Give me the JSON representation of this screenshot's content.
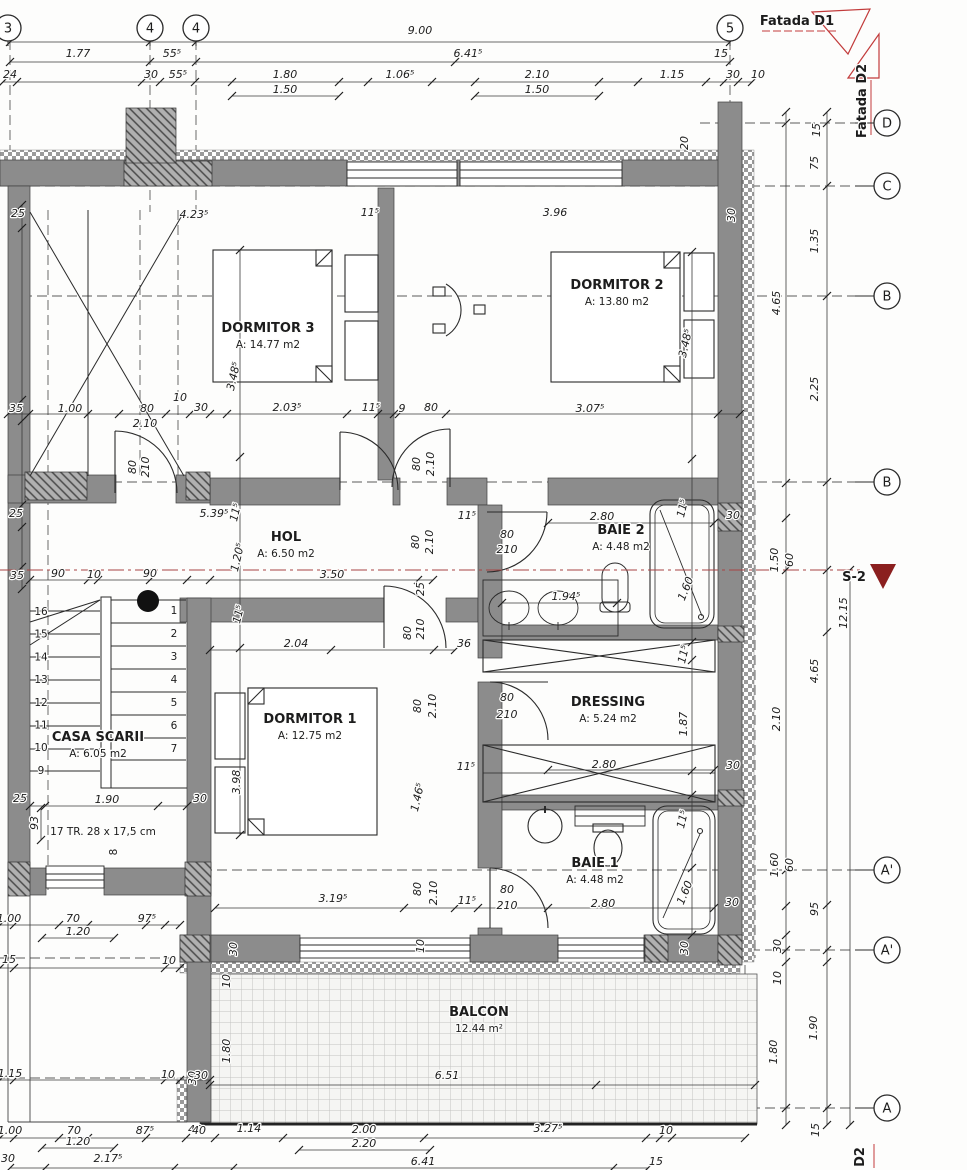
{
  "colors": {
    "wall": "#8c8c8c",
    "line": "#2a2a2a",
    "red": "#c23b3b",
    "dark_red": "#8b1f1f",
    "dim_text": "#1c1c1c"
  },
  "grid": {
    "top": [
      {
        "label": "3",
        "x": 8
      },
      {
        "label": "4",
        "x": 150
      },
      {
        "label": "4",
        "x": 196
      },
      {
        "label": "5",
        "x": 730
      }
    ],
    "right": [
      {
        "label": "D",
        "y": 123
      },
      {
        "label": "C",
        "y": 186
      },
      {
        "label": "B",
        "y": 296
      },
      {
        "label": "B",
        "y": 482
      },
      {
        "label": "A'",
        "y": 870
      },
      {
        "label": "A'",
        "y": 950
      },
      {
        "label": "A",
        "y": 1108
      }
    ]
  },
  "rooms": [
    {
      "name": "DORMITOR 3",
      "area": "A: 14.77 m2",
      "x": 268,
      "y": 332
    },
    {
      "name": "DORMITOR 2",
      "area": "A: 13.80 m2",
      "x": 617,
      "y": 289
    },
    {
      "name": "DORMITOR 1",
      "area": "A: 12.75 m2",
      "x": 310,
      "y": 723
    },
    {
      "name": "HOL",
      "area": "A: 6.50 m2",
      "x": 286,
      "y": 541
    },
    {
      "name": "BAIE 2",
      "area": "A: 4.48 m2",
      "x": 621,
      "y": 534
    },
    {
      "name": "DRESSING",
      "area": "A: 5.24 m2",
      "x": 608,
      "y": 706
    },
    {
      "name": "BAIE 1",
      "area": "A: 4.48 m2",
      "x": 595,
      "y": 867
    },
    {
      "name": "BALCON",
      "area": "12.44 m²",
      "x": 479,
      "y": 1016
    }
  ],
  "stairs": {
    "label": "CASA SCARII",
    "area": "A: 6.05 m2",
    "note": "17 TR. 28 x 17,5 cm",
    "extra_step": "8",
    "left_numbers": [
      "16",
      "15",
      "14",
      "13",
      "12",
      "11",
      "10",
      "9"
    ],
    "right_numbers": [
      "1",
      "2",
      "3",
      "4",
      "5",
      "6",
      "7"
    ]
  },
  "annotations": {
    "fatada_d1": {
      "t": "Fatada D1",
      "x": 797,
      "y": 25
    },
    "fatada_d2": {
      "t": "Fatada D2",
      "x": 866,
      "y": 101,
      "r": -90
    },
    "section": {
      "t": "S-2",
      "x": 854,
      "y": 581
    },
    "section_bottom": {
      "t": "D2",
      "x": 864,
      "y": 1157,
      "r": -90
    }
  },
  "dim_labels": [
    {
      "t": "9.00",
      "x": 420,
      "y": 34
    },
    {
      "t": "1.77",
      "x": 78,
      "y": 57
    },
    {
      "t": "55⁵",
      "x": 172,
      "y": 57
    },
    {
      "t": "6.41⁵",
      "x": 468,
      "y": 57
    },
    {
      "t": "15",
      "x": 721,
      "y": 57
    },
    {
      "t": "24",
      "x": 10,
      "y": 78
    },
    {
      "t": "30",
      "x": 151,
      "y": 78
    },
    {
      "t": "55⁵",
      "x": 178,
      "y": 78
    },
    {
      "t": "1.80",
      "x": 285,
      "y": 78
    },
    {
      "t": "1.06⁵",
      "x": 400,
      "y": 78
    },
    {
      "t": "2.10",
      "x": 537,
      "y": 78
    },
    {
      "t": "1.15",
      "x": 672,
      "y": 78
    },
    {
      "t": "30",
      "x": 733,
      "y": 78
    },
    {
      "t": "10",
      "x": 758,
      "y": 78
    },
    {
      "t": "1.50",
      "x": 285,
      "y": 93
    },
    {
      "t": "1.50",
      "x": 537,
      "y": 93
    },
    {
      "t": "20",
      "x": 688,
      "y": 143,
      "r": -90
    },
    {
      "t": "15",
      "x": 820,
      "y": 130,
      "r": -90
    },
    {
      "t": "75",
      "x": 818,
      "y": 163,
      "r": -90
    },
    {
      "t": "1.35",
      "x": 818,
      "y": 241,
      "r": -90
    },
    {
      "t": "2.25",
      "x": 818,
      "y": 389,
      "r": -90
    },
    {
      "t": "4.65",
      "x": 780,
      "y": 303,
      "r": -90
    },
    {
      "t": "1.50",
      "x": 778,
      "y": 560,
      "r": -90
    },
    {
      "t": "60",
      "x": 793,
      "y": 560,
      "r": -90
    },
    {
      "t": "12.15",
      "x": 847,
      "y": 613,
      "r": -90
    },
    {
      "t": "4.65",
      "x": 818,
      "y": 671,
      "r": -90
    },
    {
      "t": "2.10",
      "x": 780,
      "y": 719,
      "r": -90
    },
    {
      "t": "1.60",
      "x": 778,
      "y": 865,
      "r": -90
    },
    {
      "t": "60",
      "x": 793,
      "y": 865,
      "r": -90
    },
    {
      "t": "95",
      "x": 818,
      "y": 909,
      "r": -90
    },
    {
      "t": "30",
      "x": 781,
      "y": 946,
      "r": -90
    },
    {
      "t": "10",
      "x": 781,
      "y": 978,
      "r": -90
    },
    {
      "t": "1.90",
      "x": 817,
      "y": 1028,
      "r": -90
    },
    {
      "t": "1.80",
      "x": 777,
      "y": 1052,
      "r": -90
    },
    {
      "t": "15",
      "x": 819,
      "y": 1130,
      "r": -90
    },
    {
      "t": "25",
      "x": 18,
      "y": 217
    },
    {
      "t": "4.23⁵",
      "x": 194,
      "y": 218
    },
    {
      "t": "11⁵",
      "x": 370,
      "y": 216
    },
    {
      "t": "3.96",
      "x": 555,
      "y": 216
    },
    {
      "t": "30",
      "x": 735,
      "y": 215,
      "r": -90
    },
    {
      "t": "3.48⁵",
      "x": 237,
      "y": 377,
      "r": -77
    },
    {
      "t": "3.48⁵",
      "x": 689,
      "y": 344,
      "r": -77
    },
    {
      "t": "35",
      "x": 16,
      "y": 412
    },
    {
      "t": "1.00",
      "x": 70,
      "y": 412
    },
    {
      "t": "80",
      "x": 147,
      "y": 412
    },
    {
      "t": "2.10",
      "x": 145,
      "y": 427
    },
    {
      "t": "10",
      "x": 180,
      "y": 401
    },
    {
      "t": "30",
      "x": 201,
      "y": 411
    },
    {
      "t": "2.03⁵",
      "x": 287,
      "y": 411
    },
    {
      "t": "11⁵",
      "x": 371,
      "y": 411
    },
    {
      "t": "9",
      "x": 402,
      "y": 412
    },
    {
      "t": "80",
      "x": 431,
      "y": 411
    },
    {
      "t": "3.07⁵",
      "x": 590,
      "y": 412
    },
    {
      "t": "80",
      "x": 420,
      "y": 464,
      "r": -90
    },
    {
      "t": "2.10",
      "x": 434,
      "y": 464,
      "r": -90
    },
    {
      "t": "80",
      "x": 136,
      "y": 467,
      "r": -90
    },
    {
      "t": "210",
      "x": 149,
      "y": 467,
      "r": -90
    },
    {
      "t": "25",
      "x": 16,
      "y": 517
    },
    {
      "t": "5.39⁵",
      "x": 214,
      "y": 517
    },
    {
      "t": "11⁵",
      "x": 239,
      "y": 513,
      "r": -77
    },
    {
      "t": "1.20⁵",
      "x": 241,
      "y": 558,
      "r": -77
    },
    {
      "t": "3.50",
      "x": 332,
      "y": 578
    },
    {
      "t": "80",
      "x": 419,
      "y": 542,
      "r": -90
    },
    {
      "t": "2.10",
      "x": 433,
      "y": 542,
      "r": -90
    },
    {
      "t": "25",
      "x": 424,
      "y": 589,
      "r": -90
    },
    {
      "t": "11⁵",
      "x": 467,
      "y": 519
    },
    {
      "t": "80",
      "x": 507,
      "y": 538
    },
    {
      "t": "210",
      "x": 507,
      "y": 553
    },
    {
      "t": "2.80",
      "x": 602,
      "y": 520
    },
    {
      "t": "11⁵",
      "x": 686,
      "y": 509,
      "r": -77
    },
    {
      "t": "30",
      "x": 733,
      "y": 519
    },
    {
      "t": "1.94⁵",
      "x": 566,
      "y": 600
    },
    {
      "t": "1.60",
      "x": 689,
      "y": 590,
      "r": -68
    },
    {
      "t": "35",
      "x": 17,
      "y": 579
    },
    {
      "t": "90",
      "x": 58,
      "y": 577
    },
    {
      "t": "10",
      "x": 94,
      "y": 578
    },
    {
      "t": "90",
      "x": 150,
      "y": 577
    },
    {
      "t": "11⁵",
      "x": 242,
      "y": 615,
      "r": -77
    },
    {
      "t": "25",
      "x": 20,
      "y": 802
    },
    {
      "t": "1.90",
      "x": 107,
      "y": 803
    },
    {
      "t": "30",
      "x": 200,
      "y": 802
    },
    {
      "t": "93",
      "x": 38,
      "y": 823,
      "r": -90
    },
    {
      "t": "3.98",
      "x": 240,
      "y": 782,
      "r": -90
    },
    {
      "t": "2.04",
      "x": 296,
      "y": 647
    },
    {
      "t": "36",
      "x": 464,
      "y": 647
    },
    {
      "t": "80",
      "x": 411,
      "y": 633,
      "r": -90
    },
    {
      "t": "210",
      "x": 424,
      "y": 629,
      "r": -90
    },
    {
      "t": "80",
      "x": 421,
      "y": 706,
      "r": -90
    },
    {
      "t": "2.10",
      "x": 436,
      "y": 706,
      "r": -90
    },
    {
      "t": "1.46⁵",
      "x": 421,
      "y": 798,
      "r": -77
    },
    {
      "t": "11⁵",
      "x": 466,
      "y": 770
    },
    {
      "t": "3.19⁵",
      "x": 333,
      "y": 902
    },
    {
      "t": "80",
      "x": 421,
      "y": 889,
      "r": -90
    },
    {
      "t": "2.10",
      "x": 437,
      "y": 893,
      "r": -90
    },
    {
      "t": "11⁵",
      "x": 467,
      "y": 904
    },
    {
      "t": "30",
      "x": 237,
      "y": 949,
      "r": -90
    },
    {
      "t": "10",
      "x": 424,
      "y": 946,
      "r": -90
    },
    {
      "t": "80",
      "x": 507,
      "y": 701
    },
    {
      "t": "210",
      "x": 507,
      "y": 718
    },
    {
      "t": "11⁵",
      "x": 687,
      "y": 655,
      "r": -77
    },
    {
      "t": "1.87",
      "x": 687,
      "y": 724,
      "r": -90
    },
    {
      "t": "2.80",
      "x": 604,
      "y": 768
    },
    {
      "t": "30",
      "x": 733,
      "y": 769
    },
    {
      "t": "80",
      "x": 507,
      "y": 893
    },
    {
      "t": "210",
      "x": 507,
      "y": 909
    },
    {
      "t": "2.80",
      "x": 603,
      "y": 907
    },
    {
      "t": "11⁵",
      "x": 686,
      "y": 820,
      "r": -77
    },
    {
      "t": "1.60",
      "x": 688,
      "y": 894,
      "r": -68
    },
    {
      "t": "30",
      "x": 732,
      "y": 906
    },
    {
      "t": "30",
      "x": 688,
      "y": 948,
      "r": -90
    },
    {
      "t": "10",
      "x": 230,
      "y": 981,
      "r": -90
    },
    {
      "t": "1.80",
      "x": 230,
      "y": 1051,
      "r": -90
    },
    {
      "t": "30",
      "x": 196,
      "y": 1078,
      "r": -90
    },
    {
      "t": "6.51",
      "x": 447,
      "y": 1079
    },
    {
      "t": "40",
      "x": 195,
      "y": 1133
    },
    {
      "t": "1.14",
      "x": 249,
      "y": 1132
    },
    {
      "t": "2.00",
      "x": 364,
      "y": 1133
    },
    {
      "t": "2.20",
      "x": 364,
      "y": 1147
    },
    {
      "t": "3.27⁵",
      "x": 548,
      "y": 1132
    },
    {
      "t": "10",
      "x": 666,
      "y": 1134
    },
    {
      "t": "6.41",
      "x": 423,
      "y": 1165
    },
    {
      "t": "15",
      "x": 656,
      "y": 1165
    },
    {
      "t": "1.00",
      "x": 9,
      "y": 922
    },
    {
      "t": "70",
      "x": 73,
      "y": 922
    },
    {
      "t": "97⁵",
      "x": 147,
      "y": 922
    },
    {
      "t": "1.20",
      "x": 78,
      "y": 935
    },
    {
      "t": "15",
      "x": 9,
      "y": 963
    },
    {
      "t": "10",
      "x": 169,
      "y": 964
    },
    {
      "t": "1.15",
      "x": 10,
      "y": 1077
    },
    {
      "t": "10",
      "x": 168,
      "y": 1078
    },
    {
      "t": "30",
      "x": 201,
      "y": 1079
    },
    {
      "t": "1.00",
      "x": 10,
      "y": 1134
    },
    {
      "t": "70",
      "x": 74,
      "y": 1134
    },
    {
      "t": "87⁵",
      "x": 145,
      "y": 1134
    },
    {
      "t": "40",
      "x": 199,
      "y": 1134
    },
    {
      "t": "1.20",
      "x": 78,
      "y": 1145
    },
    {
      "t": "30",
      "x": 8,
      "y": 1162
    },
    {
      "t": "2.17⁵",
      "x": 108,
      "y": 1162
    }
  ],
  "ticks": [
    {
      "o": "h",
      "p": 42,
      "t": [
        10,
        150,
        196,
        730
      ]
    },
    {
      "o": "h",
      "p": 62,
      "t": [
        10,
        150,
        196,
        455,
        730
      ]
    },
    {
      "o": "h",
      "p": 82,
      "t": [
        3,
        17,
        142,
        160,
        195,
        232,
        339,
        368,
        432,
        475,
        599,
        638,
        706,
        724,
        738,
        752
      ]
    },
    {
      "o": "h",
      "p": 96,
      "t": [
        232,
        339
      ]
    },
    {
      "o": "h",
      "p": 96,
      "t": [
        475,
        599
      ]
    },
    {
      "o": "h",
      "p": 414,
      "t": [
        8,
        29,
        88,
        119,
        166,
        190,
        210,
        227,
        347,
        378,
        394,
        399,
        446,
        718,
        740
      ]
    },
    {
      "o": "h",
      "p": 580,
      "t": [
        30,
        88,
        98,
        150,
        187,
        210,
        418,
        433
      ]
    },
    {
      "o": "h",
      "p": 523,
      "t": [
        548,
        714
      ]
    },
    {
      "o": "h",
      "p": 603,
      "t": [
        502,
        617
      ]
    },
    {
      "o": "h",
      "p": 650,
      "t": [
        210,
        331,
        434,
        455
      ]
    },
    {
      "o": "h",
      "p": 770,
      "t": [
        548,
        714
      ]
    },
    {
      "o": "h",
      "p": 806,
      "t": [
        30,
        45,
        158,
        187
      ]
    },
    {
      "o": "h",
      "p": 908,
      "t": [
        215,
        404,
        455,
        478,
        548,
        714
      ]
    },
    {
      "o": "h",
      "p": 1085,
      "t": [
        210,
        596,
        755
      ]
    },
    {
      "o": "h",
      "p": 925,
      "t": [
        0,
        14,
        59,
        88,
        146,
        165,
        180
      ]
    },
    {
      "o": "h",
      "p": 938,
      "t": [
        42,
        114
      ]
    },
    {
      "o": "h",
      "p": 968,
      "t": [
        0,
        14,
        165,
        180
      ]
    },
    {
      "o": "h",
      "p": 1080,
      "t": [
        0,
        14,
        165,
        180,
        210
      ]
    },
    {
      "o": "h",
      "p": 1138,
      "t": [
        0,
        14,
        59,
        88,
        146,
        186,
        215,
        283,
        424,
        646,
        660,
        672,
        745
      ]
    },
    {
      "o": "h",
      "p": 1150,
      "t": [
        299,
        430
      ]
    },
    {
      "o": "h",
      "p": 1148,
      "t": [
        42,
        114
      ]
    },
    {
      "o": "h",
      "p": 1168,
      "t": [
        10,
        45,
        174,
        233,
        613,
        648
      ]
    },
    {
      "o": "v",
      "p": 786,
      "t": [
        112,
        123,
        483,
        518,
        570,
        870,
        906,
        935,
        950,
        962,
        1108,
        1125
      ]
    },
    {
      "o": "v",
      "p": 827,
      "t": [
        112,
        123,
        186,
        296,
        482,
        570,
        632,
        905,
        950,
        962,
        1108,
        1125
      ]
    },
    {
      "o": "v",
      "p": 850,
      "t": [
        570,
        1125
      ]
    },
    {
      "o": "v",
      "p": 240,
      "t": [
        250,
        457,
        648,
        835
      ]
    },
    {
      "o": "v",
      "p": 692,
      "t": [
        252,
        459,
        642,
        660,
        771,
        795,
        868,
        935
      ]
    },
    {
      "o": "v",
      "p": 41,
      "t": [
        808,
        840
      ]
    },
    {
      "o": "v",
      "p": 22,
      "t": [
        205,
        228,
        400,
        421,
        505,
        527,
        567,
        589
      ]
    }
  ]
}
